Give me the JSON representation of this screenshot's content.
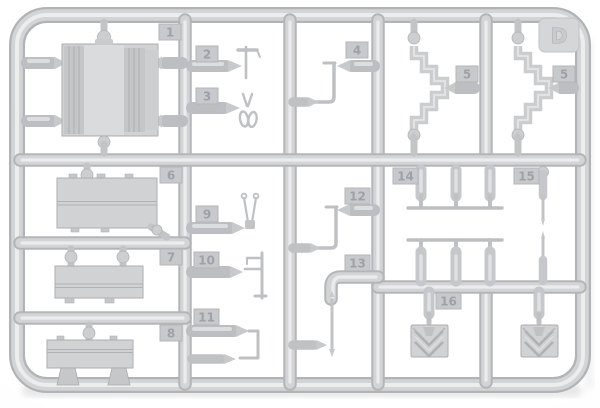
{
  "photo_subject": {
    "description": "Light grey injection-moulded model kit sprue (runner frame) with numbered parts",
    "sprue_letter": "D"
  },
  "tags": [
    {
      "label": "1"
    },
    {
      "label": "2"
    },
    {
      "label": "3"
    },
    {
      "label": "4"
    },
    {
      "label": "5"
    },
    {
      "label": "5"
    },
    {
      "label": "6"
    },
    {
      "label": "7"
    },
    {
      "label": "8"
    },
    {
      "label": "9"
    },
    {
      "label": "10"
    },
    {
      "label": "11"
    },
    {
      "label": "12"
    },
    {
      "label": "13"
    },
    {
      "label": "14"
    },
    {
      "label": "15"
    },
    {
      "label": "16"
    }
  ],
  "letter_tab": {
    "label": "D"
  },
  "colors": {
    "background": "#fbfbfc",
    "plastic_base": "#d2d3d5",
    "plastic_shadow": "#b2b3b6",
    "plastic_highlight": "#ececed",
    "tag_number": "#9fa1a6"
  }
}
